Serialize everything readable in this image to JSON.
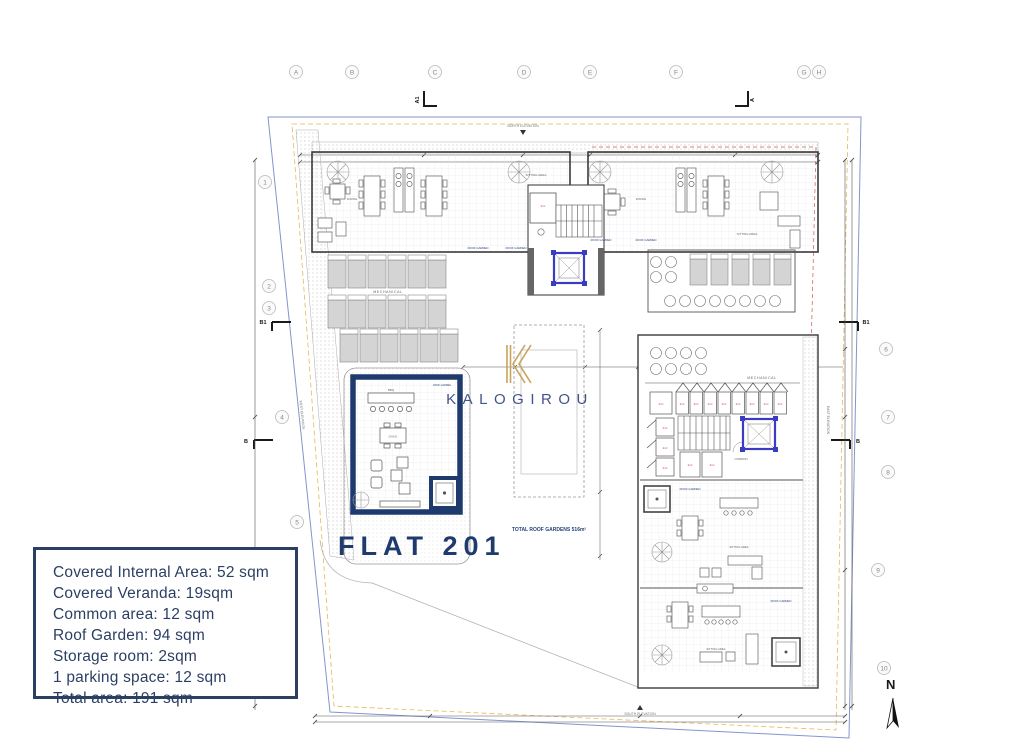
{
  "colors": {
    "accent_navy": "#1f3a6d",
    "logo_gold": "#c9a45c",
    "elevator_blue": "#3c3cc0",
    "storage_red": "#cc3366",
    "boundary_blue": "#8495cc",
    "boundary_orange": "#e5b95a",
    "boundary_red": "#cc5555"
  },
  "branding": {
    "logo_text": "KALOGIROU"
  },
  "title": {
    "flat_label": "FLAT 201"
  },
  "summary_box": {
    "lines": [
      "Covered Internal Area: 52 sqm",
      "Covered Veranda: 19sqm",
      "Common area: 12 sqm",
      "Roof Garden: 94 sqm",
      "Storage room: 2sqm",
      "1 parking space: 12 sqm",
      "Total area: 191 sqm"
    ]
  },
  "plan": {
    "grid_columns": [
      "A",
      "B",
      "C",
      "D",
      "E",
      "F",
      "G",
      "H"
    ],
    "grid_rows": [
      "1",
      "2",
      "3",
      "4",
      "5",
      "6",
      "7",
      "8",
      "9",
      "10"
    ],
    "section_marks": {
      "a1": "A1",
      "a": "A",
      "b1": "B1",
      "b": "B"
    },
    "labels": {
      "north_elevation": "NORTH ELEVATION",
      "south_elevation": "SOUTH ELEVATION",
      "east_elevation": "EAST ELEVATION",
      "west_elevation": "WEST ELEVATION",
      "mechanical": "MECHANICAL",
      "total_roof_gardens": "TOTAL ROOF GARDENS 516m²",
      "north_symbol": "N",
      "sitting_area": "SITTING AREA",
      "dining": "DINING",
      "bbq": "BBQ",
      "roof_garden": "ROOF GARDEN",
      "common": "COMMON",
      "storage_tag": "2m²"
    }
  }
}
